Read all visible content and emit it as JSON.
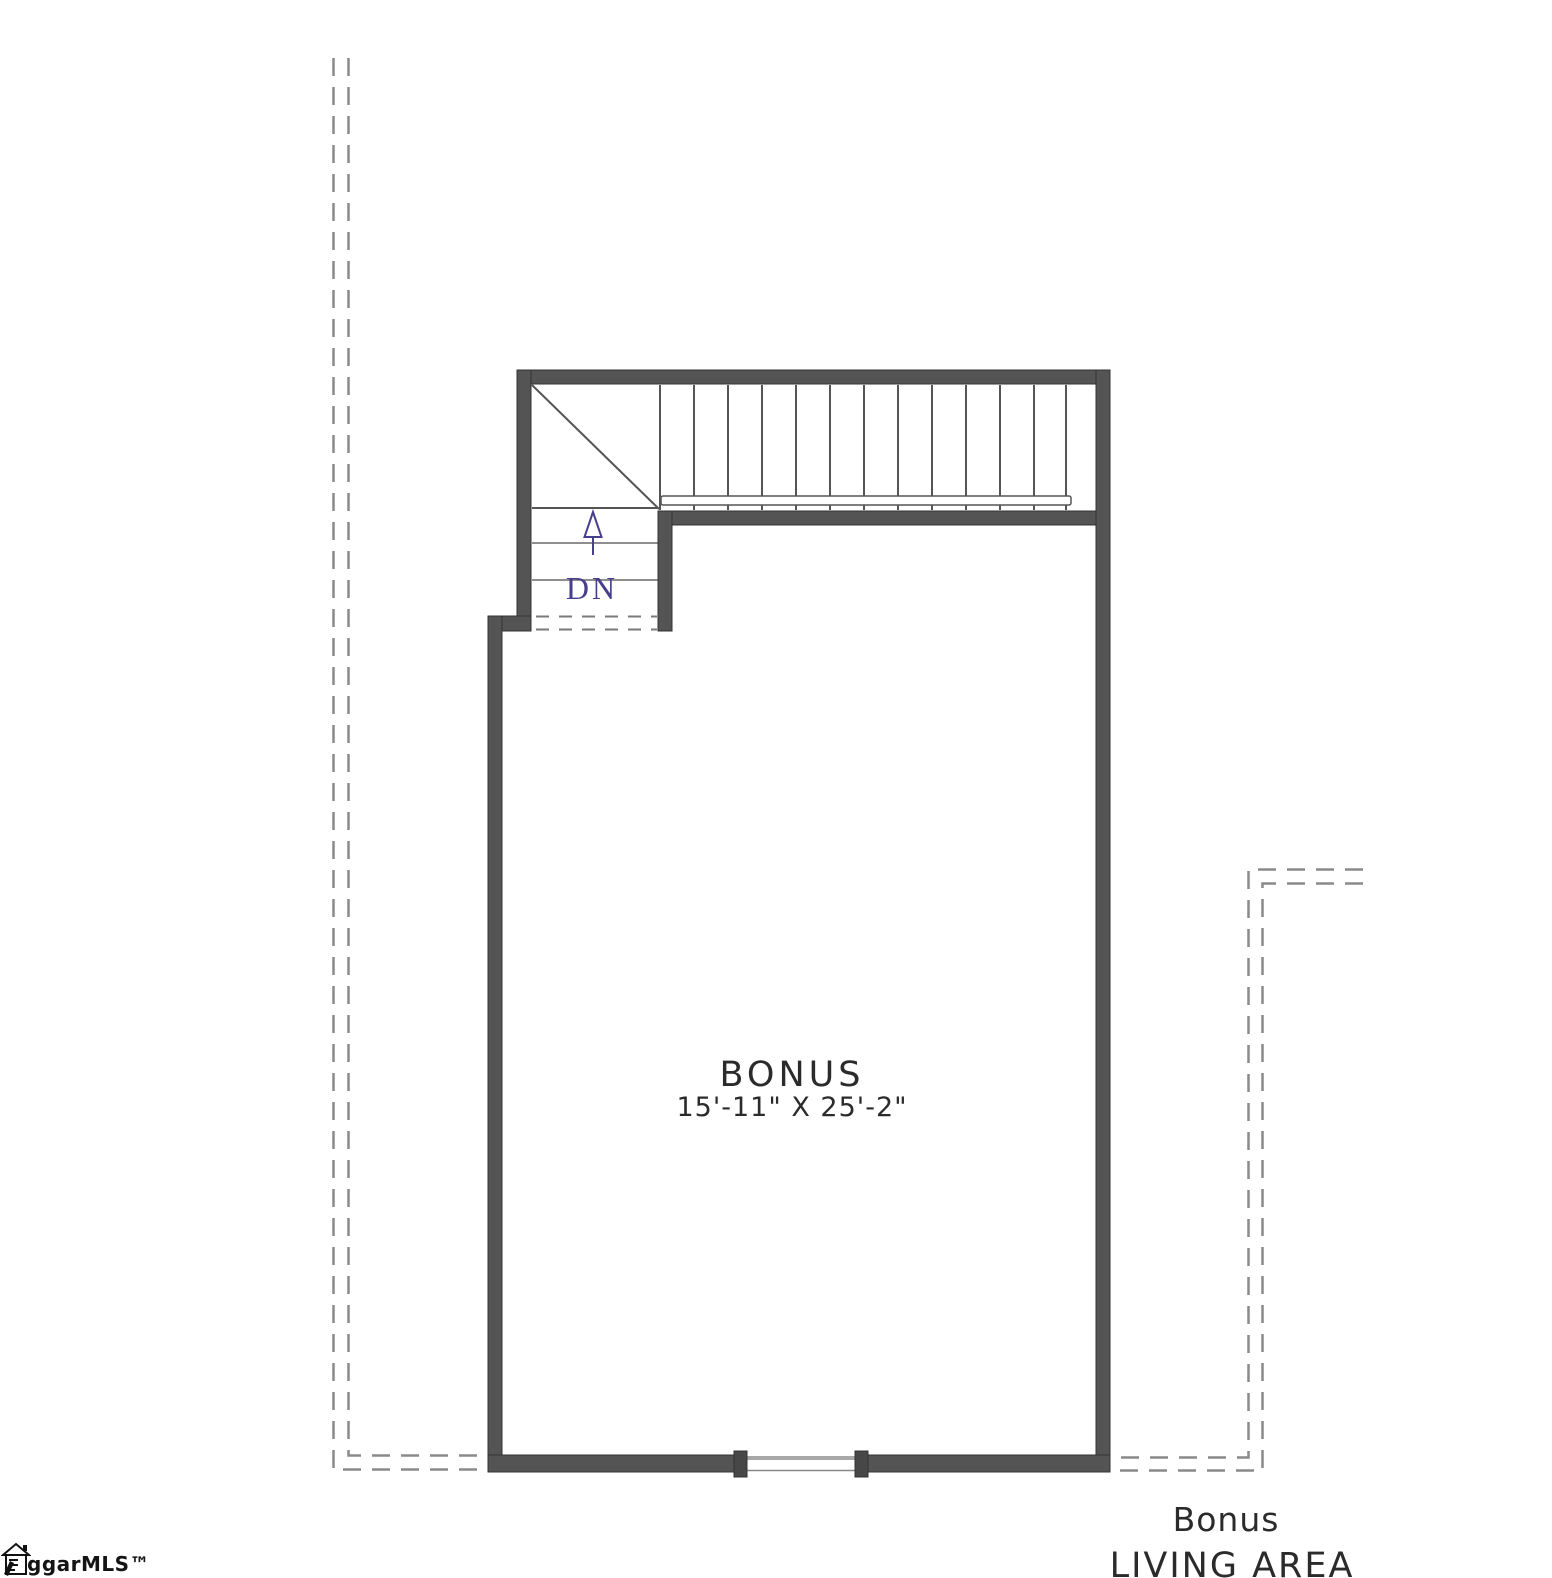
{
  "floor_plan": {
    "room": {
      "name": "BONUS",
      "dimensions": "15'-11\" X 25'-2\""
    },
    "stairs": {
      "direction_label": "DN",
      "tread_count": 13,
      "arrow": "up-arrow"
    },
    "area_label": {
      "line1": "Bonus",
      "line2": "LIVING AREA"
    },
    "watermark": {
      "text": "ggarMLS™",
      "icon": "house-icon"
    },
    "colors": {
      "background": "#ffffff",
      "wall_fill": "#545454",
      "wall_edge": "#333333",
      "thin_line": "#555555",
      "dashed_line": "#8a8a8a",
      "opening_line": "#a8a8a8",
      "stair_annotation_blue": "#453f8e",
      "label_text": "#2b2b2b",
      "watermark_text": "#141414"
    }
  }
}
